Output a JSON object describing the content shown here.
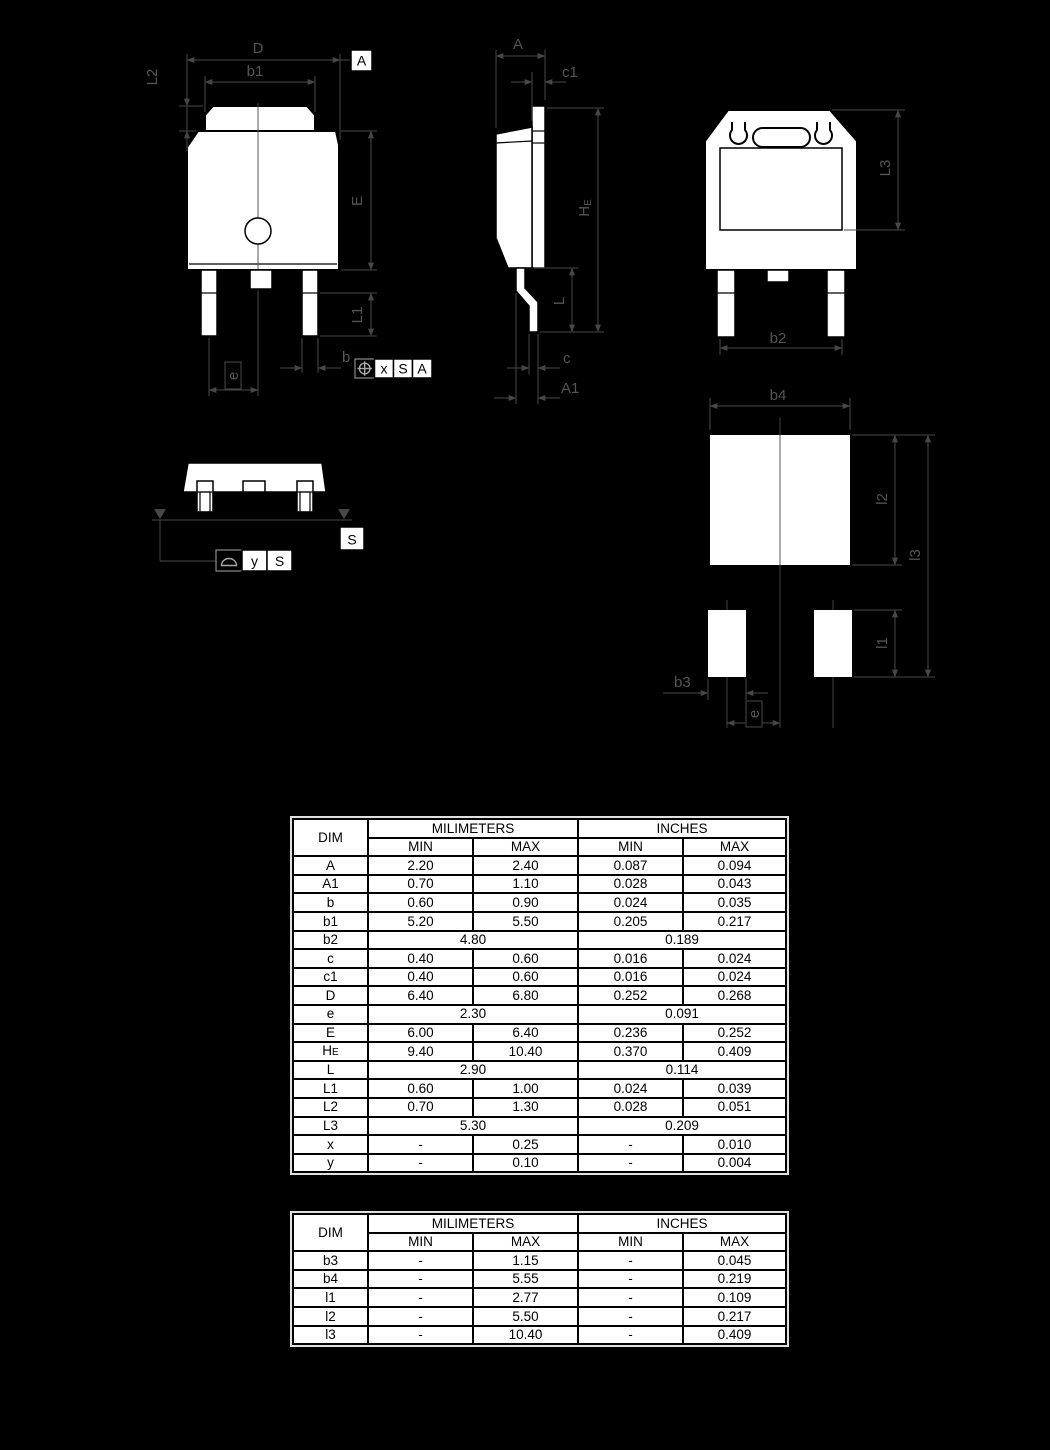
{
  "colors": {
    "page_bg": "#000000",
    "linework": "#474747",
    "shape_fill": "#ffffff",
    "shape_outline": "#000000",
    "table_bg": "#ffffff",
    "table_text": "#000000"
  },
  "drawing": {
    "front": {
      "d": "D",
      "b1": "b1",
      "l2": "L2",
      "e_body": "E",
      "l1": "L1",
      "b": "b",
      "e": "e",
      "datum": "A",
      "fcf": [
        "x",
        "S",
        "A"
      ]
    },
    "side": {
      "a": "A",
      "c1": "c1",
      "he_main": "H",
      "he_sub": "E",
      "l": "L",
      "c": "c",
      "a1": "A1"
    },
    "back": {
      "l3": "L3",
      "b2": "b2"
    },
    "footprint": {
      "b4": "b4",
      "l2": "l2",
      "l3": "l3",
      "l1": "l1",
      "b3": "b3",
      "e": "e"
    },
    "bottom": {
      "datum": "S",
      "fcf": [
        "y",
        "S"
      ]
    }
  },
  "tables": [
    {
      "headers": {
        "dim": "DIM",
        "mm": "MILIMETERS",
        "in": "INCHES",
        "min": "MIN",
        "max": "MAX"
      },
      "rows": [
        {
          "d": "A",
          "v": [
            "2.20",
            "2.40",
            "0.087",
            "0.094"
          ]
        },
        {
          "d": "A1",
          "v": [
            "0.70",
            "1.10",
            "0.028",
            "0.043"
          ]
        },
        {
          "d": "b",
          "v": [
            "0.60",
            "0.90",
            "0.024",
            "0.035"
          ]
        },
        {
          "d": "b1",
          "v": [
            "5.20",
            "5.50",
            "0.205",
            "0.217"
          ]
        },
        {
          "d": "b2",
          "span": [
            "4.80",
            "0.189"
          ]
        },
        {
          "d": "c",
          "v": [
            "0.40",
            "0.60",
            "0.016",
            "0.024"
          ]
        },
        {
          "d": "c1",
          "v": [
            "0.40",
            "0.60",
            "0.016",
            "0.024"
          ]
        },
        {
          "d": "D",
          "v": [
            "6.40",
            "6.80",
            "0.252",
            "0.268"
          ]
        },
        {
          "d": "e",
          "span": [
            "2.30",
            "0.091"
          ]
        },
        {
          "d": "E",
          "v": [
            "6.00",
            "6.40",
            "0.236",
            "0.252"
          ]
        },
        {
          "d": "H",
          "sub": "E",
          "v": [
            "9.40",
            "10.40",
            "0.370",
            "0.409"
          ]
        },
        {
          "d": "L",
          "span": [
            "2.90",
            "0.114"
          ]
        },
        {
          "d": "L1",
          "v": [
            "0.60",
            "1.00",
            "0.024",
            "0.039"
          ]
        },
        {
          "d": "L2",
          "v": [
            "0.70",
            "1.30",
            "0.028",
            "0.051"
          ]
        },
        {
          "d": "L3",
          "span": [
            "5.30",
            "0.209"
          ]
        },
        {
          "d": "x",
          "v": [
            "-",
            "0.25",
            "-",
            "0.010"
          ]
        },
        {
          "d": "y",
          "v": [
            "-",
            "0.10",
            "-",
            "0.004"
          ]
        }
      ]
    },
    {
      "headers": {
        "dim": "DIM",
        "mm": "MILIMETERS",
        "in": "INCHES",
        "min": "MIN",
        "max": "MAX"
      },
      "rows": [
        {
          "d": "b3",
          "v": [
            "-",
            "1.15",
            "-",
            "0.045"
          ]
        },
        {
          "d": "b4",
          "v": [
            "-",
            "5.55",
            "-",
            "0.219"
          ]
        },
        {
          "d": "l1",
          "v": [
            "-",
            "2.77",
            "-",
            "0.109"
          ]
        },
        {
          "d": "l2",
          "v": [
            "-",
            "5.50",
            "-",
            "0.217"
          ]
        },
        {
          "d": "l3",
          "v": [
            "-",
            "10.40",
            "-",
            "0.409"
          ]
        }
      ]
    }
  ]
}
